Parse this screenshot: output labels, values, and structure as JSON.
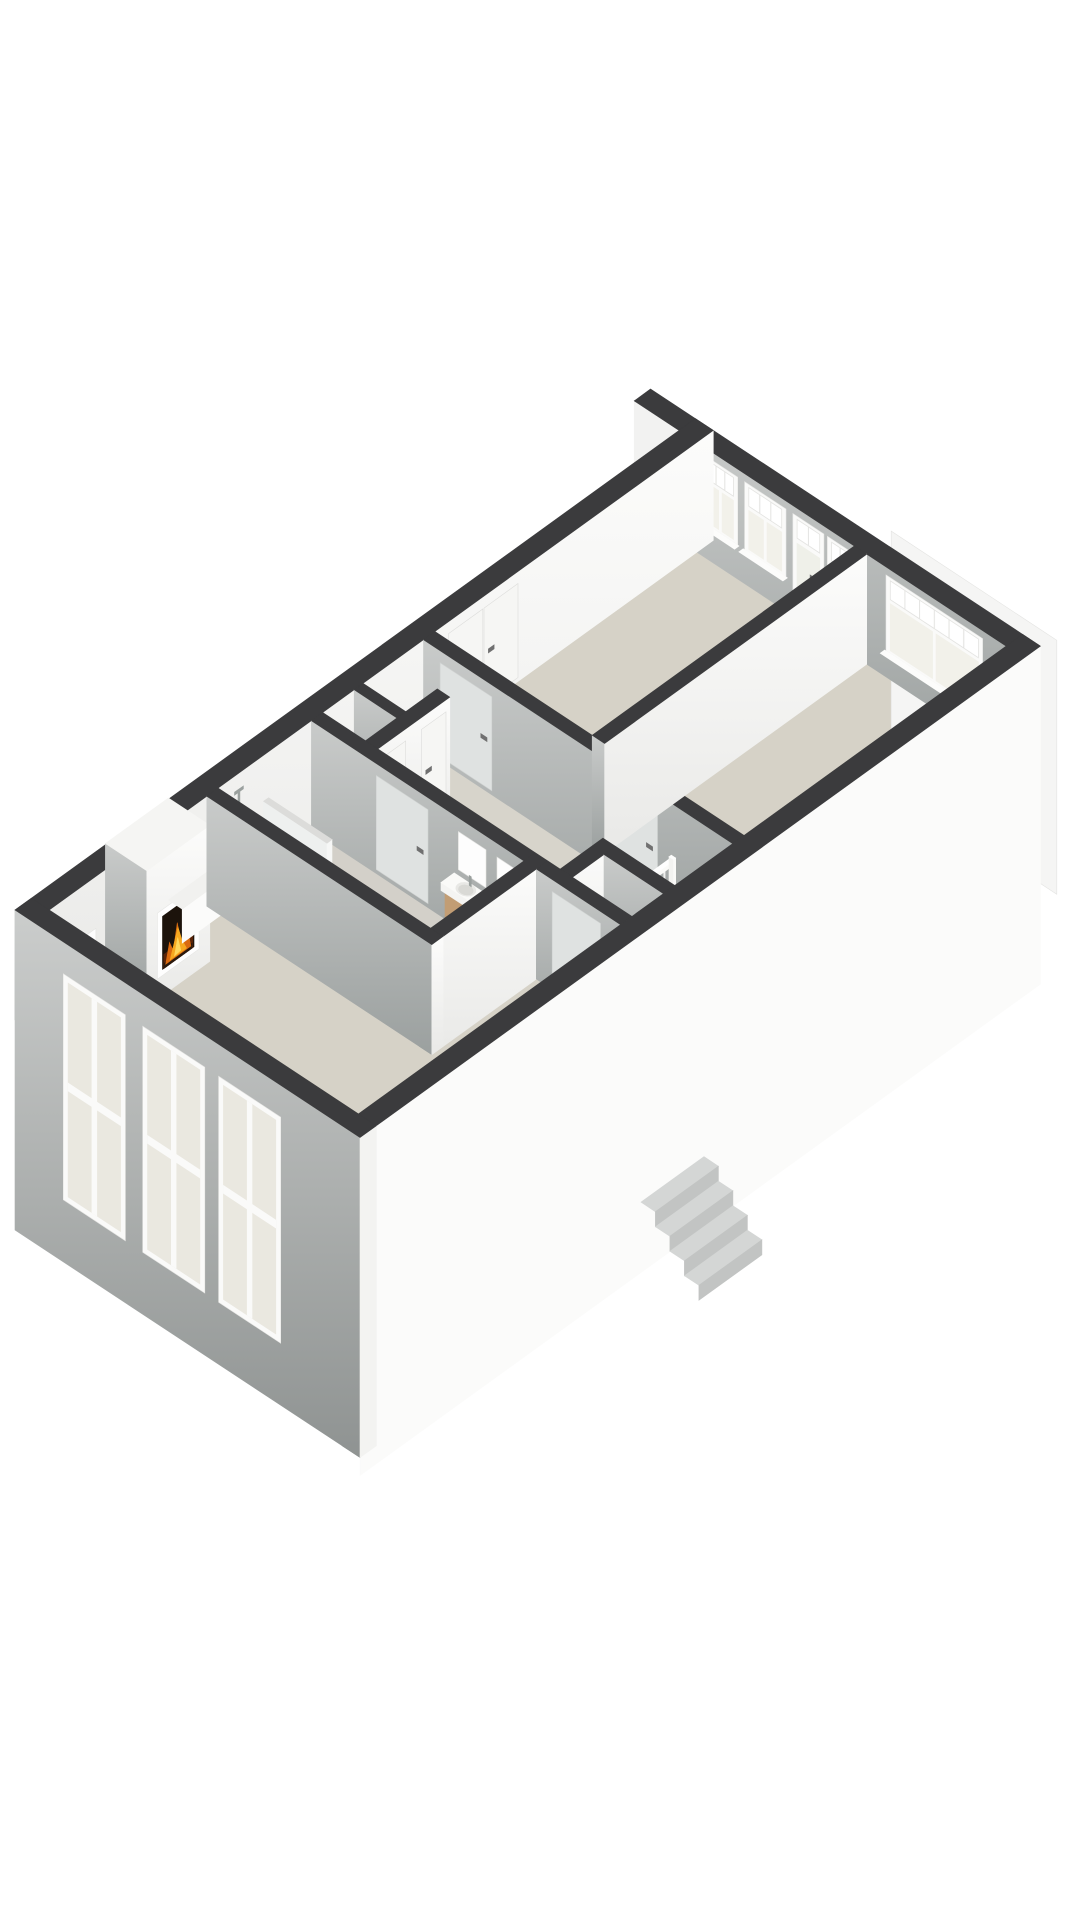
{
  "meta": {
    "content_type": "3d-floorplan-render",
    "view": "axonometric-cutaway",
    "background": "#ffffff"
  },
  "palette": {
    "wall_top": "#3b3b3d",
    "face_white_hi": "#fcfcfb",
    "face_white_lo": "#e9e9e7",
    "face_gray_hi": "#c9cbca",
    "face_gray_lo": "#9ba09f",
    "facade_gray_hi": "#cbcdcc",
    "facade_gray_lo": "#8f9392",
    "floor": "#d6d2c7",
    "floor_bath": "#d3d0c9",
    "floor_hall": "#d7d4cb",
    "floor_shower": "#cac9c3",
    "stair_well": "#a9a69d",
    "glass_pale": "#f2f1ea",
    "glass_ext": "#eae8e0",
    "transom_bg": "#e4e4e2",
    "frame_white": "#fafaf9",
    "wood_front": "#c29d74",
    "wood_side": "#a9855c",
    "basin_white": "#fafaf8",
    "fire_dark": "#1c130b",
    "fire_glow": "#5a2408",
    "fire_deep": "#d96a10",
    "fire_mid": "#f6a81f",
    "fire_hi": "#ffd75c",
    "door_on_gray": "#dfe2e1",
    "door_on_white": "#f6f6f4",
    "handle": "#707070",
    "ext_step_top": "#d4d6d5",
    "ext_step_side": "#c2c4c3",
    "neighbor_white": "#f5f5f4"
  },
  "rooms": [
    {
      "name": "living-room",
      "features": [
        "fireplace",
        "three-facade-windows",
        "radiator",
        "side-ledge"
      ]
    },
    {
      "name": "bathroom",
      "features": [
        "walk-in-shower",
        "glass-partition",
        "two-wood-vanity-sinks",
        "mirrors"
      ]
    },
    {
      "name": "hallway",
      "features": [
        "staircase-down",
        "balustrade",
        "landing-block"
      ]
    },
    {
      "name": "bedroom-1",
      "features": [
        "built-in-closet-doors",
        "two-windows",
        "two-glazed-doors"
      ]
    },
    {
      "name": "bedroom-2",
      "features": [
        "double-window"
      ]
    },
    {
      "name": "bedroom-3",
      "features": [
        "door-to-hall"
      ]
    },
    {
      "name": "toilet",
      "features": [
        "door"
      ]
    },
    {
      "name": "storage-closet",
      "features": [
        "door"
      ]
    }
  ],
  "structure": {
    "plan_size": {
      "x": 108,
      "y": 50
    },
    "wall_height": 110,
    "exterior_walls": {
      "nw": [
        0,
        0,
        108,
        2.6
      ],
      "sw": [
        0,
        0,
        2.6,
        50
      ],
      "ne": [
        105.4,
        0,
        108,
        50
      ],
      "se": [
        0,
        47.4,
        108,
        50
      ],
      "stub": [
        105.4,
        -6.5,
        108,
        0
      ]
    },
    "skirts": {
      "sw_depth": 210,
      "se_depth": 228
    },
    "interior_walls": {
      "l1": [
        27.6,
        2.6,
        29.4,
        35.2
      ],
      "l2": [
        27.6,
        33.4,
        46,
        35.2
      ],
      "w5": [
        44.2,
        2.6,
        46,
        33.4
      ],
      "w6": [
        44.2,
        35.2,
        46,
        47.4
      ],
      "l3": [
        62,
        2.6,
        63.8,
        47.4
      ],
      "l4": [
        63.8,
        25.4,
        105.4,
        27.2
      ],
      "tw_divider": [
        51,
        2.6,
        52.4,
        8.8
      ],
      "tw_south": [
        46,
        8.8,
        57.4,
        10.6
      ],
      "closet_north": [
        46,
        37,
        52.8,
        38.8
      ],
      "closet_east": [
        51,
        38.8,
        52.8,
        47.4
      ]
    },
    "floors": {
      "slab": [
        2.6,
        2.6,
        105.4,
        47.4
      ],
      "bathroom": [
        29.4,
        2.6,
        44.2,
        33.4
      ],
      "hall": [
        46,
        2.6,
        62,
        47.4
      ],
      "shower": [
        29.4,
        2.6,
        36.6,
        11.8
      ],
      "stairwell": [
        52.8,
        38.8,
        62,
        47.4
      ]
    },
    "windows_ne": [
      {
        "type": "window",
        "y": [
          3.5,
          8.5
        ]
      },
      {
        "type": "window",
        "y": [
          9.5,
          15.5
        ]
      },
      {
        "type": "glazed-door",
        "y": [
          16.5,
          21.0
        ]
      },
      {
        "type": "glazed-door",
        "y": [
          21.5,
          25.2
        ]
      },
      {
        "type": "double-window",
        "y": [
          30,
          44
        ]
      }
    ],
    "windows_sw": [
      {
        "y": [
          7,
          16
        ]
      },
      {
        "y": [
          18.5,
          27.5
        ]
      },
      {
        "y": [
          29.5,
          38.5
        ]
      }
    ],
    "doors": [
      {
        "wall": "l3",
        "face": "w",
        "y": [
          5,
          12.5
        ],
        "name": "bedroom-1-door"
      },
      {
        "wall": "l3",
        "face": "w",
        "y": [
          29,
          36.5
        ],
        "name": "bedroom-2-door"
      },
      {
        "wall": "w5",
        "face": "w",
        "y": [
          12,
          19.5
        ],
        "name": "bathroom-door"
      },
      {
        "wall": "w6",
        "face": "w",
        "y": [
          37.5,
          44.5
        ],
        "name": "bedroom-3-door"
      },
      {
        "wall": "tw_south",
        "face": "s",
        "x": [
          46.6,
          50.4
        ],
        "name": "toilet-door"
      },
      {
        "wall": "tw_south",
        "face": "s",
        "x": [
          52.9,
          56.8
        ],
        "name": "storage-door"
      },
      {
        "wall": "nw",
        "face": "s",
        "x": [
          66,
          71.4
        ],
        "name": "closet-door-left"
      },
      {
        "wall": "nw",
        "face": "s",
        "x": [
          71.6,
          77
        ],
        "name": "closet-door-right"
      }
    ],
    "fireplace": {
      "chimney": [
        11.5,
        2.6,
        21.5,
        8.6
      ],
      "height": 136,
      "firebox_x": [
        13.2,
        19.8
      ],
      "firebox_z": [
        20,
        86
      ],
      "ledge": [
        21.5,
        2.6,
        27.6,
        4.6
      ],
      "ledge_height": 34
    },
    "radiator": {
      "x": [
        5,
        10
      ],
      "z": [
        18,
        58
      ]
    },
    "shower": {
      "glass_wall": [
        36.6,
        2.6,
        37.4,
        11.8
      ],
      "glass_height": 64,
      "set_x": 32.7
    },
    "vanities": [
      [
        42.4,
        23.6,
        44.2,
        28.2
      ],
      [
        42.4,
        29.2,
        44.2,
        33.2
      ]
    ],
    "vanity_height": 44,
    "mirrors": [
      {
        "y": [
          23.9,
          27.9
        ]
      },
      {
        "y": [
          29.5,
          32.9
        ]
      }
    ],
    "stairs": {
      "opening": [
        52.8,
        38.8,
        62,
        47.4
      ],
      "steps": 6,
      "step_depth": 1.3,
      "landing": [
        60.6,
        38.8,
        62,
        47.4
      ],
      "landing_height": 13,
      "balustrade": {
        "y": 38.8,
        "x": [
          52.8,
          62
        ],
        "rail_top": 56,
        "spindle_height": 49,
        "spindle_gap": 1.04
      }
    },
    "exterior_stairs": {
      "x": [
        43.5,
        53.5
      ],
      "y_start": 51,
      "step_w": 2.1,
      "steps": 4,
      "z_top": -148,
      "drop": 15
    },
    "neighbor_wall": {
      "x": 110.6,
      "y": [
        26,
        50
      ],
      "z_top": 104,
      "z_bottom": -150
    }
  }
}
